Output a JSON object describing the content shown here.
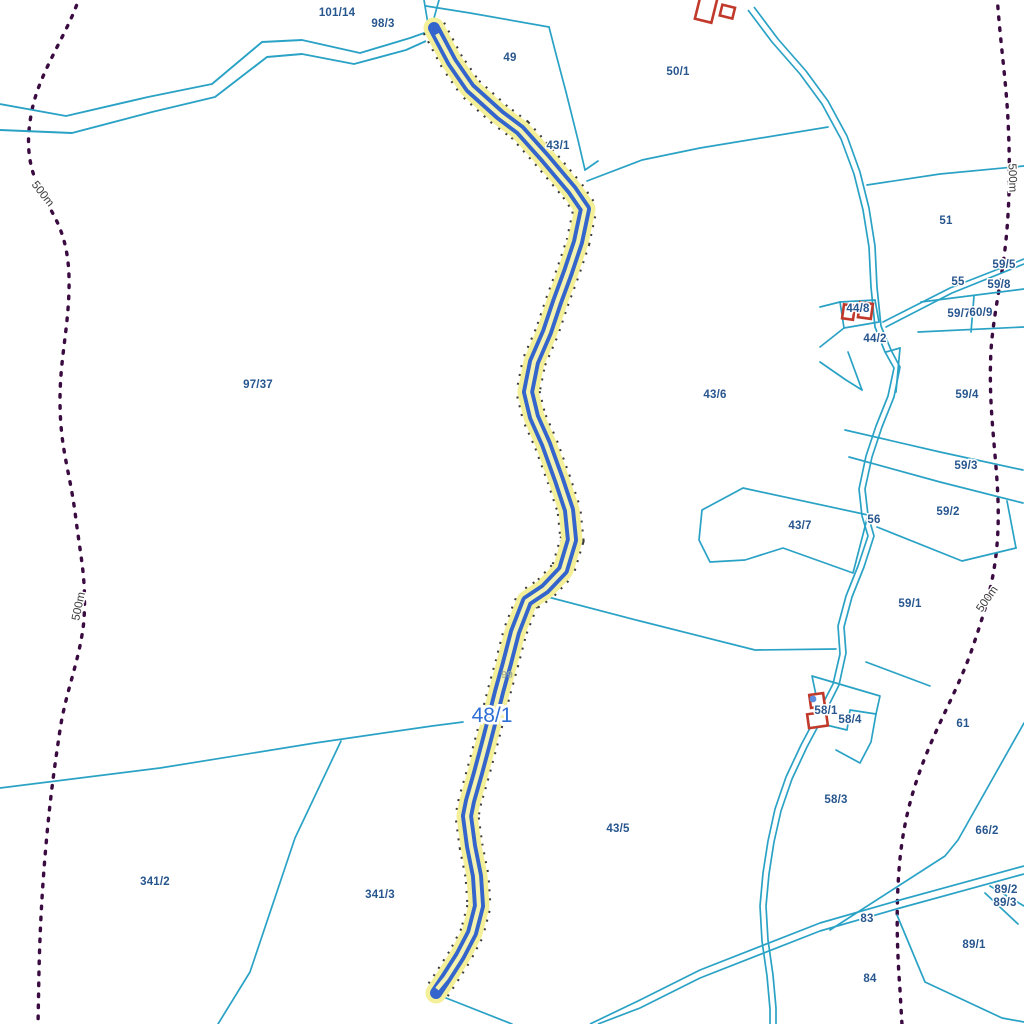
{
  "map": {
    "type": "cadastral-parcel-map",
    "selected_parcel": {
      "label": "48/1",
      "x": 492,
      "y": 722
    },
    "colors": {
      "background": "#ffffff",
      "boundary_teal": "#2aa2c5",
      "contour_purple": "#3a0b40",
      "building_red": "#c0392b",
      "highlight_yellow": "#f4ef99",
      "highlight_blue": "#3465cc",
      "label_blue": "#27568e",
      "selected_label_blue": "#2e6fd6",
      "survey_dot_blue": "#5b8ee0"
    },
    "parcel_labels": [
      {
        "text": "101/14",
        "x": 337,
        "y": 16
      },
      {
        "text": "98/3",
        "x": 383,
        "y": 27
      },
      {
        "text": "49",
        "x": 510,
        "y": 61
      },
      {
        "text": "50/1",
        "x": 678,
        "y": 75
      },
      {
        "text": "43/1",
        "x": 558,
        "y": 149
      },
      {
        "text": "51",
        "x": 946,
        "y": 224
      },
      {
        "text": "59/5",
        "x": 1004,
        "y": 268
      },
      {
        "text": "55",
        "x": 958,
        "y": 285
      },
      {
        "text": "59/8",
        "x": 999,
        "y": 288
      },
      {
        "text": "59/7",
        "x": 959,
        "y": 317
      },
      {
        "text": "60/9",
        "x": 981,
        "y": 316
      },
      {
        "text": "44/8",
        "x": 858,
        "y": 312
      },
      {
        "text": "44/2",
        "x": 875,
        "y": 342
      },
      {
        "text": "97/37",
        "x": 258,
        "y": 388
      },
      {
        "text": "43/6",
        "x": 715,
        "y": 398
      },
      {
        "text": "59/4",
        "x": 967,
        "y": 398
      },
      {
        "text": "59/3",
        "x": 966,
        "y": 469
      },
      {
        "text": "59/2",
        "x": 948,
        "y": 515
      },
      {
        "text": "43/7",
        "x": 800,
        "y": 529
      },
      {
        "text": "56",
        "x": 874,
        "y": 523
      },
      {
        "text": "59/1",
        "x": 910,
        "y": 607
      },
      {
        "text": "58/1",
        "x": 826,
        "y": 714
      },
      {
        "text": "58/4",
        "x": 850,
        "y": 723
      },
      {
        "text": "61",
        "x": 963,
        "y": 727
      },
      {
        "text": "58/3",
        "x": 836,
        "y": 803
      },
      {
        "text": "66/2",
        "x": 987,
        "y": 834
      },
      {
        "text": "43/5",
        "x": 618,
        "y": 832
      },
      {
        "text": "341/2",
        "x": 155,
        "y": 885
      },
      {
        "text": "341/3",
        "x": 380,
        "y": 898
      },
      {
        "text": "89/2",
        "x": 1006,
        "y": 893
      },
      {
        "text": "89/3",
        "x": 1005,
        "y": 906
      },
      {
        "text": "83",
        "x": 867,
        "y": 922
      },
      {
        "text": "89/1",
        "x": 974,
        "y": 948
      },
      {
        "text": "84",
        "x": 870,
        "y": 982
      }
    ],
    "hidden_label": {
      "text": "99",
      "x": 507,
      "y": 678
    },
    "contour_labels": [
      {
        "text": "500m",
        "x": 40,
        "y": 196,
        "rot": 52
      },
      {
        "text": "500m",
        "x": 82,
        "y": 607,
        "rot": -78
      },
      {
        "text": "500m",
        "x": 1009,
        "y": 178,
        "rot": 88
      },
      {
        "text": "500m",
        "x": 990,
        "y": 601,
        "rot": -55
      }
    ]
  }
}
